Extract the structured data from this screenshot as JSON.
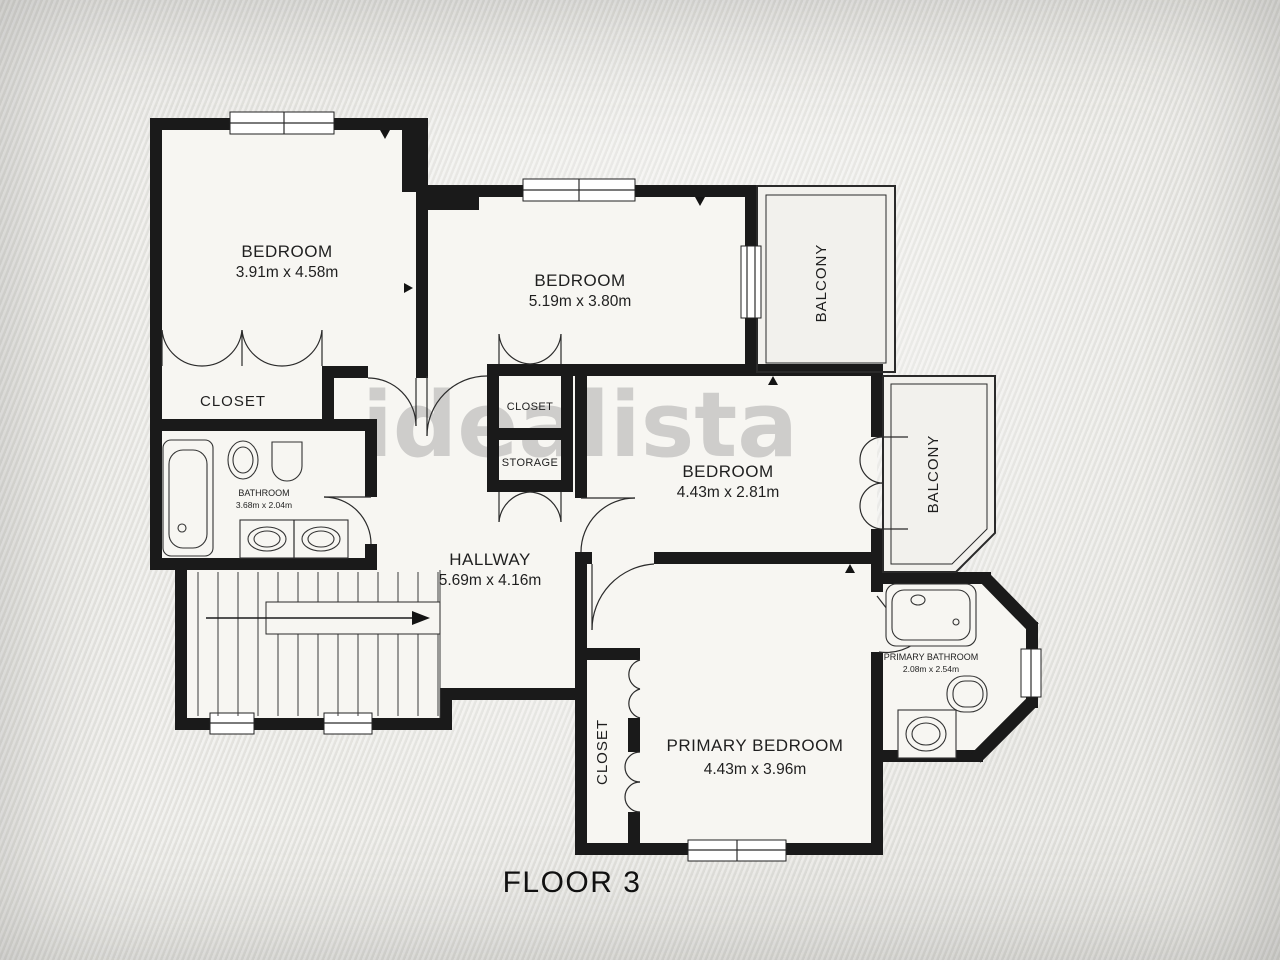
{
  "colors": {
    "wall": "#1a1a1a",
    "floor": "#f7f6f2",
    "background": "#e8e7e4",
    "watermark_gray": "#a6a6a6"
  },
  "plan": {
    "title": "FLOOR 3",
    "watermark": "idealista",
    "rooms": {
      "bedroom1": {
        "name": "BEDROOM",
        "dims": "3.91m x 4.58m"
      },
      "bedroom2": {
        "name": "BEDROOM",
        "dims": "5.19m x 3.80m"
      },
      "bedroom3": {
        "name": "BEDROOM",
        "dims": "4.43m x 2.81m"
      },
      "primary_bedroom": {
        "name": "PRIMARY BEDROOM",
        "dims": "4.43m x 3.96m"
      },
      "hallway": {
        "name": "HALLWAY",
        "dims": "5.69m x 4.16m"
      },
      "bathroom": {
        "name": "BATHROOM",
        "dims": "3.68m x 2.04m"
      },
      "primary_bathroom": {
        "name": "PRIMARY BATHROOM",
        "dims": "2.08m x 2.54m"
      },
      "closet_main": {
        "name": "CLOSET"
      },
      "closet_hall": {
        "name": "CLOSET"
      },
      "storage": {
        "name": "STORAGE"
      },
      "closet_primary": {
        "name": "CLOSET"
      },
      "balcony_top": {
        "name": "BALCONY"
      },
      "balcony_right": {
        "name": "BALCONY"
      }
    }
  }
}
